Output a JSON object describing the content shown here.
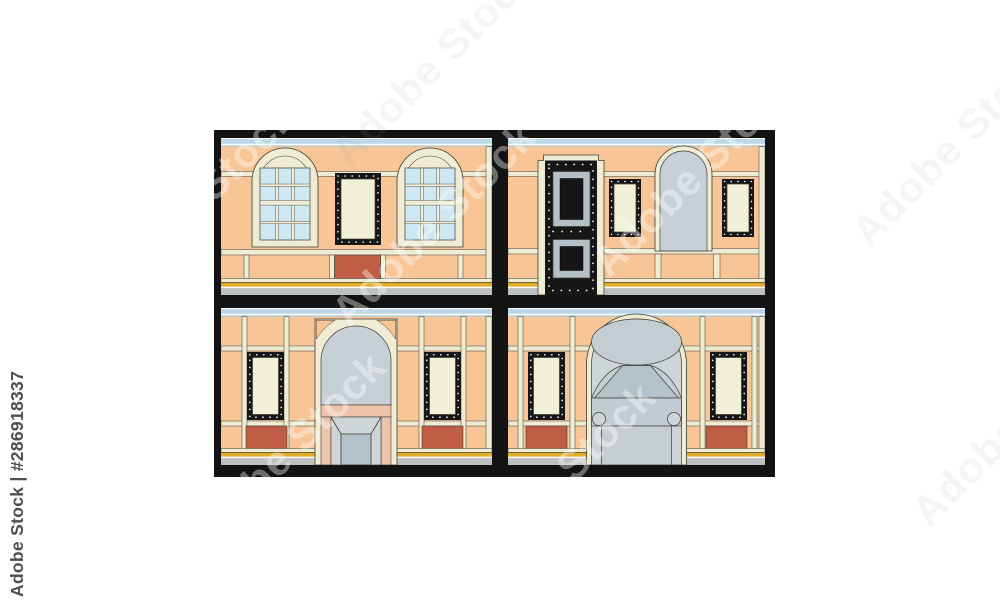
{
  "watermark": {
    "vertical_label": "Adobe Stock | #286918337",
    "ghost_label": "Adobe Stock",
    "asset_id": "#286918337"
  },
  "image": {
    "rows": 2,
    "cols": 2,
    "panels": [
      {
        "id": "top-left",
        "features": [
          "arched grid window",
          "studded black window",
          "arched grid window",
          "red wall panel"
        ]
      },
      {
        "id": "top-right",
        "features": [
          "black paneled door with studs",
          "studded black window",
          "arched gray niche",
          "studded black window"
        ]
      },
      {
        "id": "bottom-left",
        "features": [
          "studded black window",
          "arched entrance with awning",
          "studded black window",
          "red wall panels"
        ]
      },
      {
        "id": "bottom-right",
        "features": [
          "studded black window",
          "grand arched entrance with canopy and porthole door",
          "studded black window",
          "red wall panels"
        ]
      }
    ]
  },
  "colors": {
    "wall": "#f8c596",
    "trim": "#efecd3",
    "glassBlue": "#cfe6f3",
    "glassCream": "#f1f1da",
    "frameBlack": "#161616",
    "border": "#131313",
    "strip": "#b9d8eb",
    "stripEdge": "#a3cce3",
    "gold": "#e3af28",
    "goldEdge": "#8c7a1e",
    "sidewalk": "#bcc0c0",
    "red": "#bf5e44",
    "grayNiche": "#c7d0d6",
    "grayLight": "#ced5d6",
    "grayMid": "#c4cdd2",
    "grayBlue": "#b5c2c9",
    "grayBand": "#c2cbd1",
    "grayDoor": "#c6ced2",
    "pink": "#eec3ab",
    "silver": "#b4c0c5",
    "outline": "#3d3d35",
    "wmText": "#4e4e4e"
  }
}
